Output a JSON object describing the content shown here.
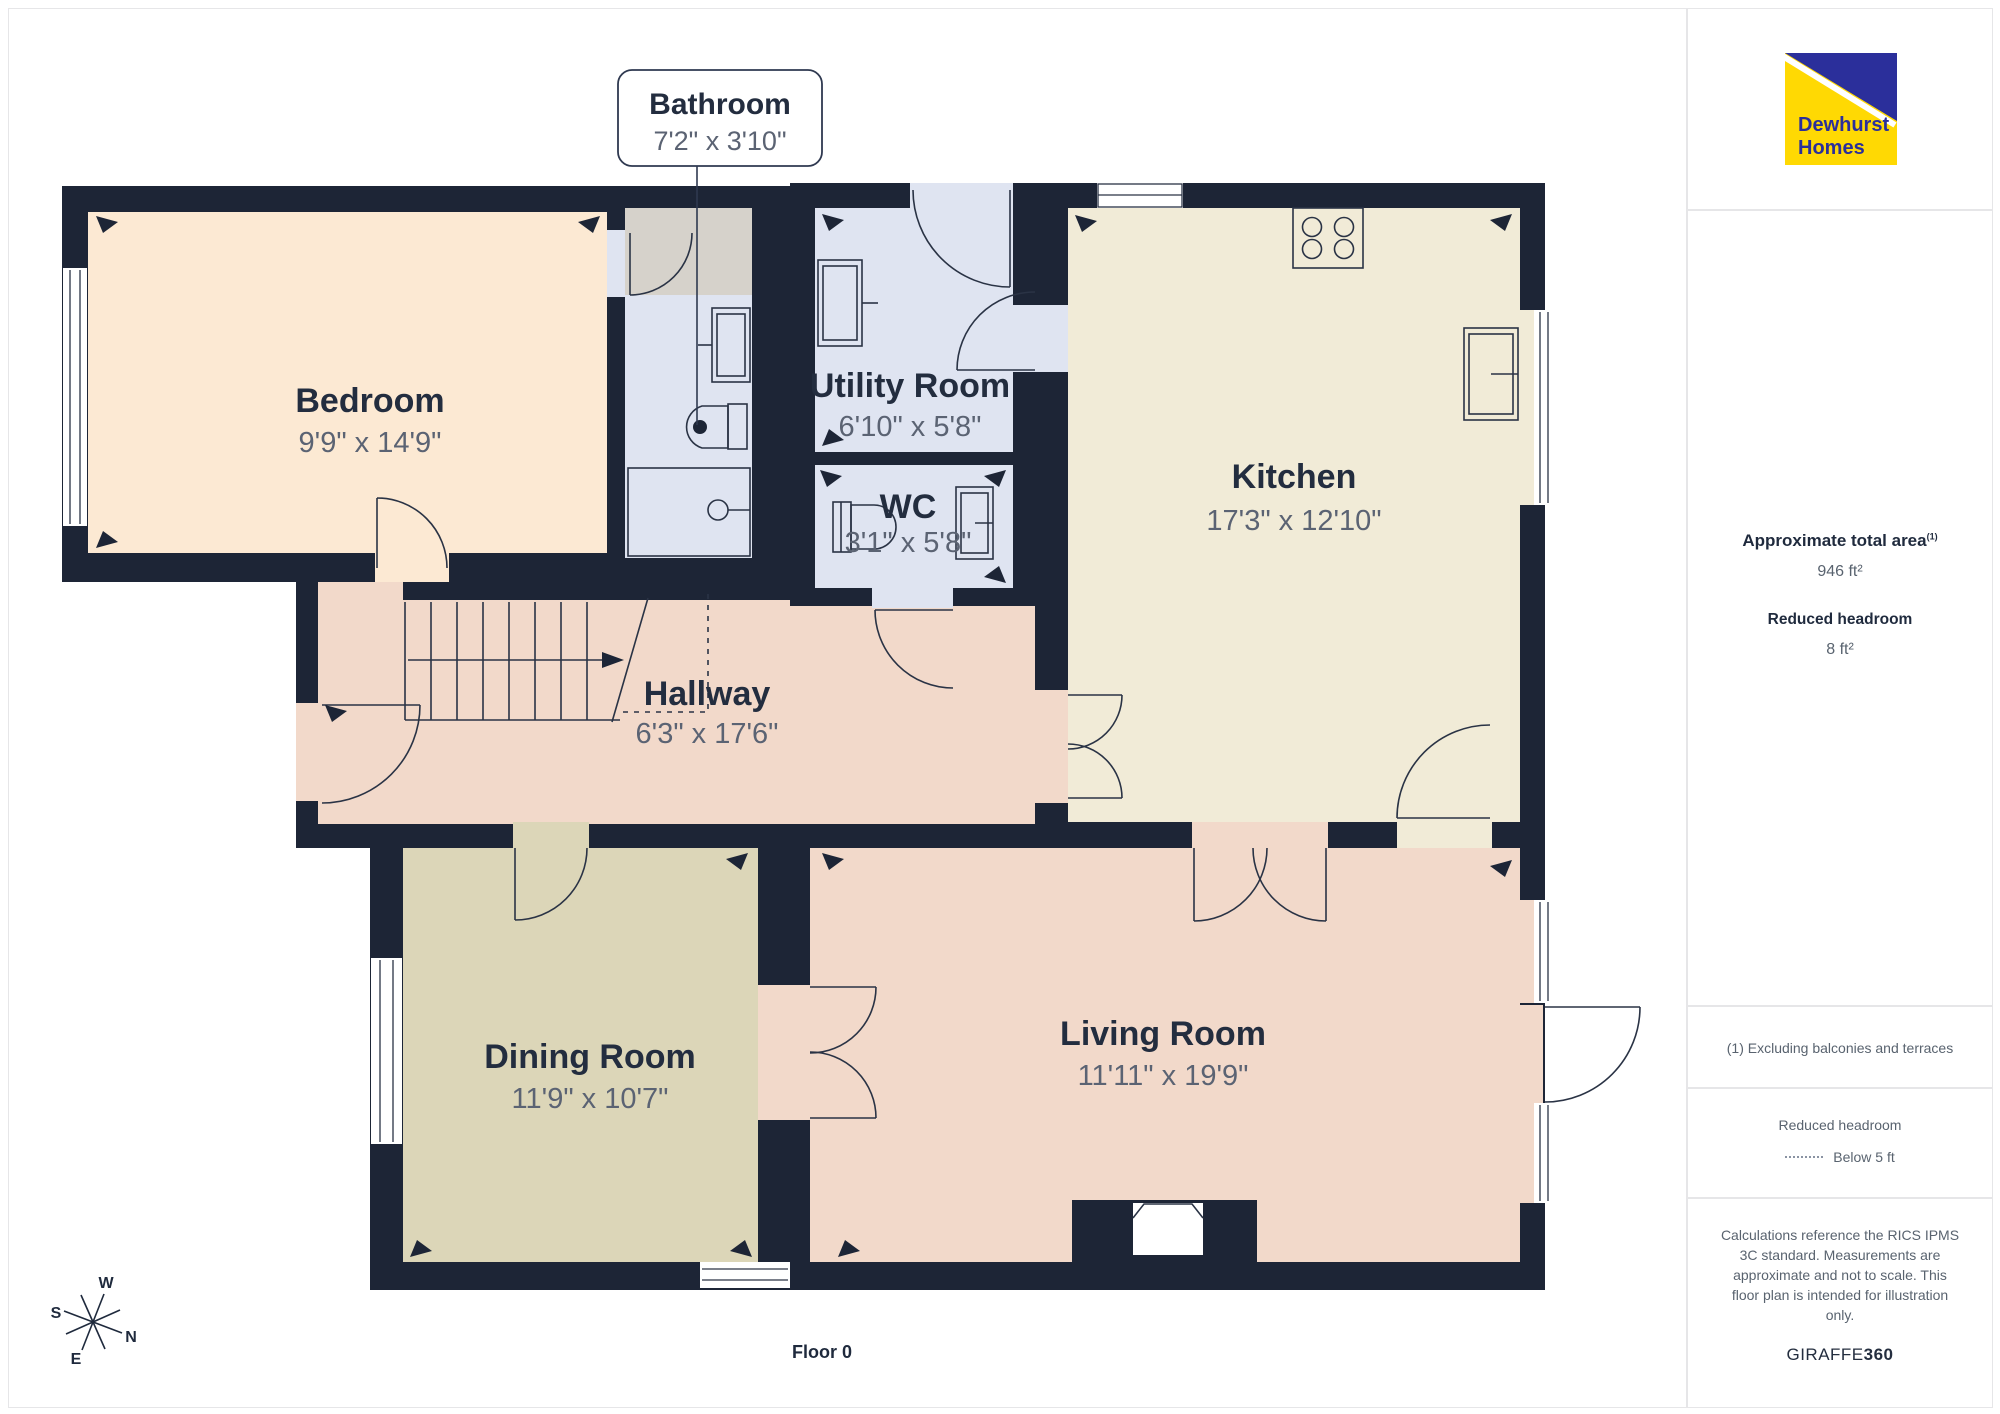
{
  "plan": {
    "floor_label": "Floor 0",
    "compass": {
      "n": "N",
      "s": "S",
      "e": "E",
      "w": "W"
    },
    "rooms": [
      {
        "name": "Bedroom",
        "dims": "9'9\" x 14'9\""
      },
      {
        "name": "Bathroom",
        "dims": "7'2\" x 3'10\""
      },
      {
        "name": "Utility Room",
        "dims": "6'10\" x 5'8\""
      },
      {
        "name": "WC",
        "dims": "3'1\" x 5'8\""
      },
      {
        "name": "Kitchen",
        "dims": "17'3\" x 12'10\""
      },
      {
        "name": "Hallway",
        "dims": "6'3\" x 17'6\""
      },
      {
        "name": "Dining Room",
        "dims": "11'9\" x 10'7\""
      },
      {
        "name": "Living Room",
        "dims": "11'11\" x 19'9\""
      }
    ]
  },
  "sidebar": {
    "logo": {
      "line1": "Dewhurst",
      "line2": "Homes"
    },
    "area": {
      "label": "Approximate total area",
      "superscript": "(1)",
      "value": "946 ft²"
    },
    "headroom": {
      "label": "Reduced headroom",
      "value": "8 ft²"
    },
    "note": "(1) Excluding balconies and terraces",
    "legend": {
      "title": "Reduced headroom",
      "item": "Below 5 ft"
    },
    "disclaimer": {
      "lines": [
        "Calculations reference the RICS IPMS",
        "3C standard. Measurements are",
        "approximate and not to scale. This",
        "floor plan is intended for illustration",
        "only."
      ],
      "brand_normal": "GIRAFFE",
      "brand_bold": "360"
    }
  },
  "colors": {
    "wall": "#1d2536",
    "bedroom": "#fce9d3",
    "wet_rooms": "#dfe4f1",
    "shower_area": "#d6d2cb",
    "kitchen": "#f1ebd7",
    "hall_living": "#f2d9ca",
    "dining": "#dcd6b8",
    "label_dark": "#232d3f",
    "label_gray": "#5b6373",
    "logo_yellow": "#ffd903",
    "logo_blue": "#2b2f9b",
    "panel_border": "#e6e6e8"
  }
}
